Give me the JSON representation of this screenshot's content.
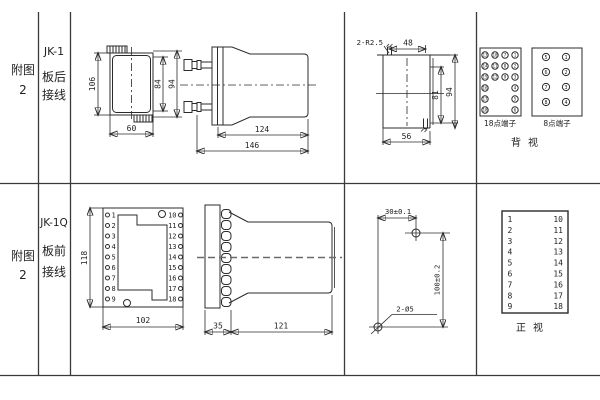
{
  "sidebar": {
    "top": {
      "figure": "附图2",
      "model": "JK-1",
      "wiring": "板后接线"
    },
    "bottom": {
      "figure": "附图2",
      "model": "JK-1Q",
      "wiring": "板前接线"
    }
  },
  "rear_wiring": {
    "case_rear_view": {
      "height": "106",
      "inner_height": "84",
      "outer_height": "94",
      "width": "60"
    },
    "case_side_view": {
      "body_length": "124",
      "total_length": "146"
    },
    "panel_cutout_view": {
      "slot_note": "2-R2.5",
      "slot_span_h": "48",
      "slot_span_v": "81",
      "overall_height": "94",
      "width": "56"
    },
    "terminal_block_18": {
      "label": "18点端子",
      "rows": [
        [
          "13",
          "10",
          "7",
          "1"
        ],
        [
          "14",
          "11",
          "8",
          "2"
        ],
        [
          "15",
          "12",
          "9",
          "3"
        ],
        [
          "16",
          "",
          "",
          "4"
        ],
        [
          "17",
          "",
          "",
          "5"
        ],
        [
          "18",
          "",
          "",
          "6"
        ]
      ]
    },
    "terminal_block_8": {
      "label": "8点端子",
      "rows": [
        [
          "5",
          "1"
        ],
        [
          "6",
          "2"
        ],
        [
          "7",
          "3"
        ],
        [
          "8",
          "4"
        ]
      ]
    },
    "view_label": "背视"
  },
  "front_wiring": {
    "front_view": {
      "height": "118",
      "width": "102",
      "left_terminals": [
        "1",
        "2",
        "3",
        "4",
        "5",
        "6",
        "7",
        "8",
        "9"
      ],
      "right_terminals": [
        "10",
        "11",
        "12",
        "13",
        "14",
        "15",
        "16",
        "17",
        "18"
      ]
    },
    "side_view": {
      "plate_depth": "35",
      "body_length": "121"
    },
    "drill_plan": {
      "hole_span_h": "30±0.1",
      "hole_span_v": "100±0.2",
      "holes_note": "2-Ø5"
    },
    "terminal_table": {
      "left": [
        "1",
        "2",
        "3",
        "4",
        "5",
        "6",
        "7",
        "8",
        "9"
      ],
      "right": [
        "10",
        "11",
        "12",
        "13",
        "14",
        "15",
        "16",
        "17",
        "18"
      ],
      "view_label": "正视"
    }
  }
}
